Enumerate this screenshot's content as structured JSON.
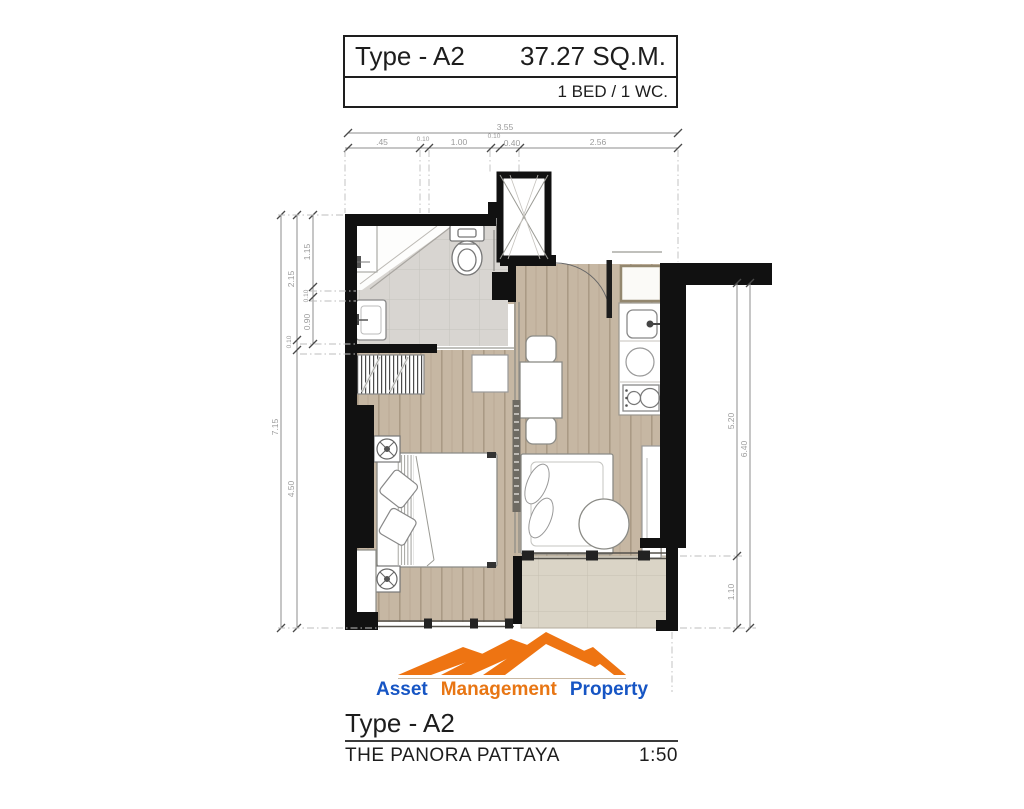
{
  "header": {
    "type_label": "Type - A2",
    "area": "37.27 SQ.M.",
    "config": "1 BED / 1 WC."
  },
  "footer": {
    "type_label": "Type - A2",
    "project": "THE PANORA PATTAYA",
    "scale": "1:50"
  },
  "logo": {
    "word1": "Asset",
    "word2": "Management",
    "word3": "Property",
    "icon": "mountain-logo-icon"
  },
  "dims": {
    "top": {
      "overall": "3.55",
      "s1": ".45",
      "s2": "0.10",
      "s3": "1.00",
      "s4": "0.10",
      "s5": "0.40",
      "s6": "2.56"
    },
    "left": {
      "overall": "7.15",
      "mid1": "2.15",
      "mid2": "0.10",
      "mid3": "4.50",
      "in1": "1.15",
      "in2": "0.10",
      "in3": "0.90"
    },
    "right": {
      "overall": "6.40",
      "s1": "5.20",
      "s2": "1.10"
    }
  },
  "colors": {
    "wall": "#111111",
    "wood_floor": "#c6b7a3",
    "bath_tile": "#d8d5d1",
    "balcony_tile": "#dad4c6",
    "logo_orange": "#ee7412",
    "logo_blue": "#1655c4",
    "dim_text": "#9b9b9b"
  }
}
